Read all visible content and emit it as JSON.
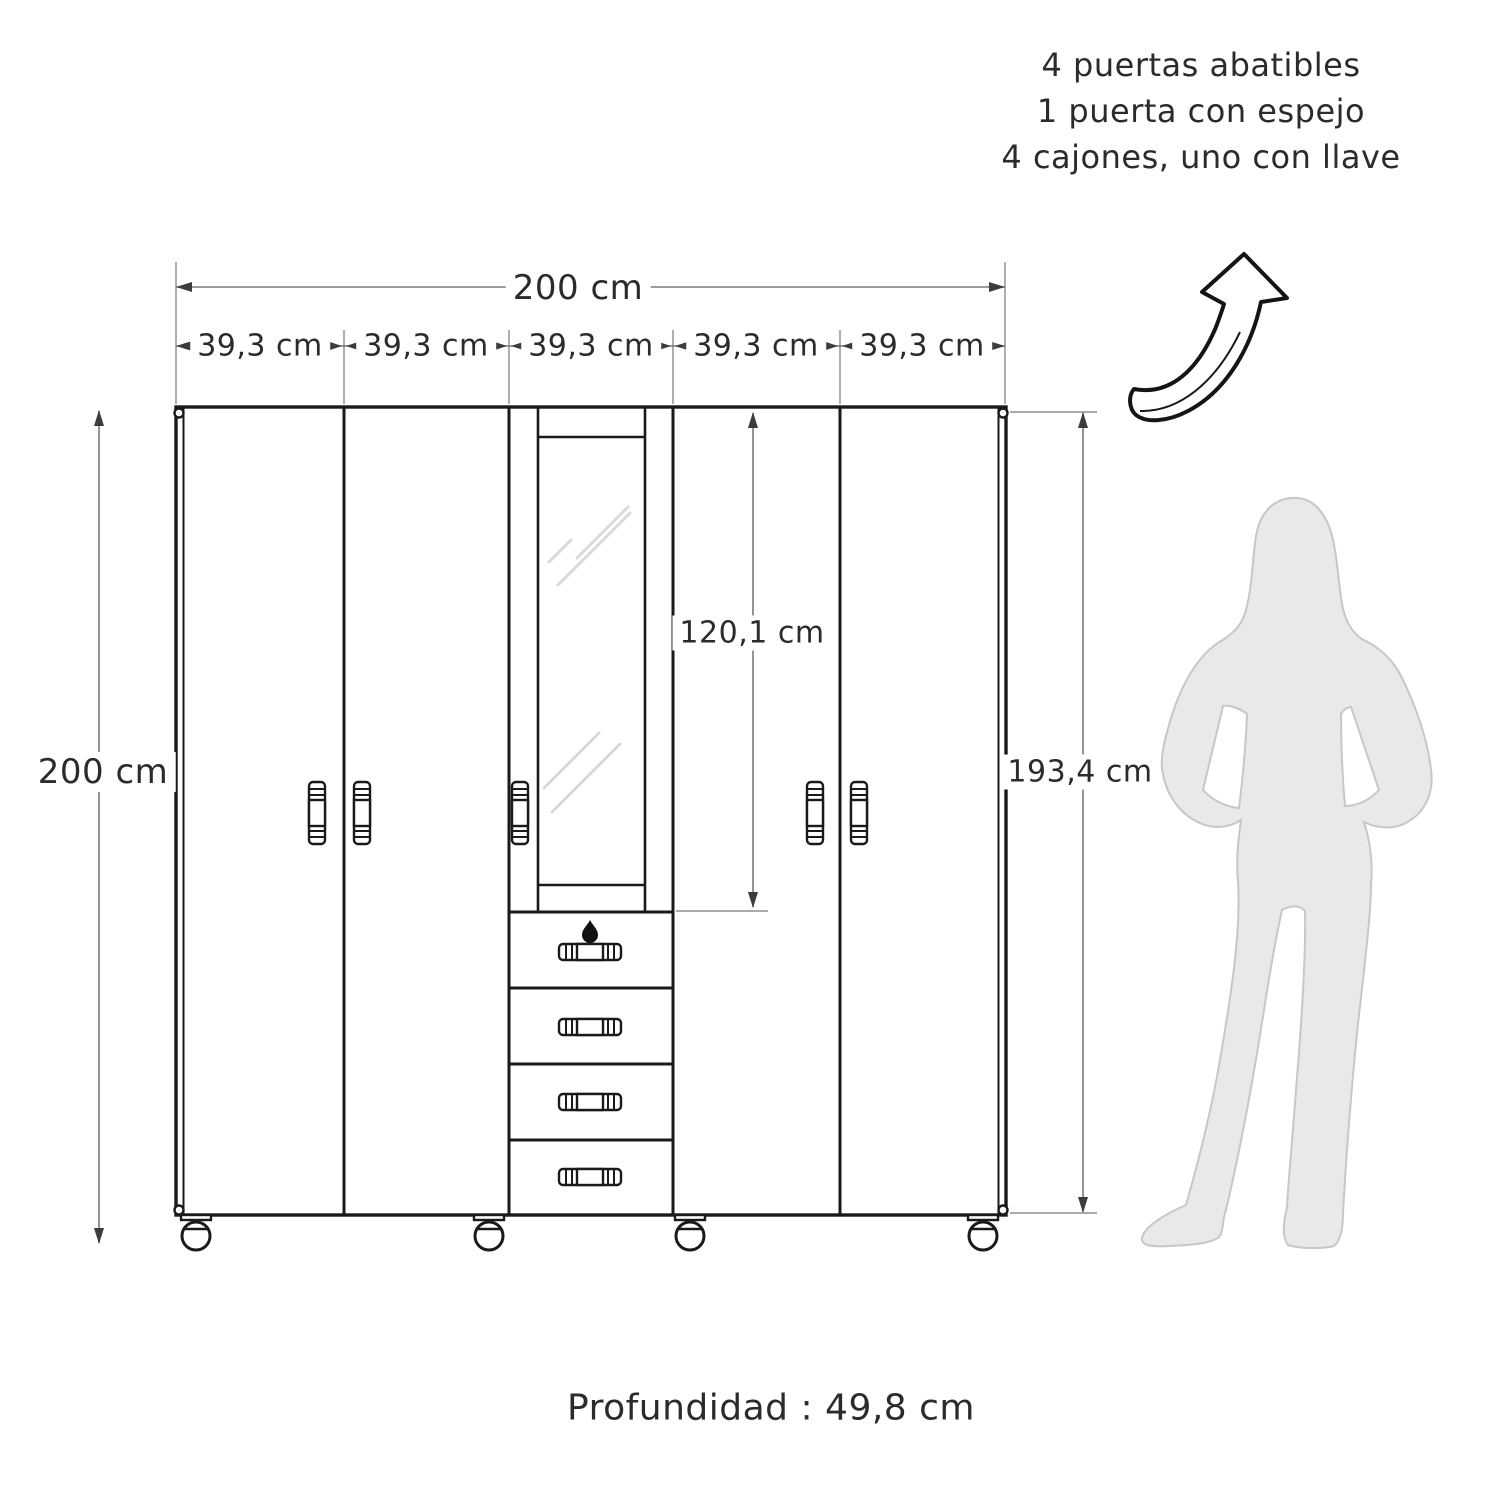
{
  "notes": {
    "lines": [
      "4 puertas abatibles",
      "1 puerta con espejo",
      "4 cajones, uno con llave"
    ]
  },
  "dimensions": {
    "total_width": "200 cm",
    "section_widths": [
      "39,3 cm",
      "39,3 cm",
      "39,3 cm",
      "39,3 cm",
      "39,3 cm"
    ],
    "total_height": "200 cm",
    "body_height": "193,4 cm",
    "mirror_door_height": "120,1 cm",
    "depth_note": "Profundidad : 49,8 cm"
  },
  "icons": {
    "arrow": "curved-up-right-arrow",
    "lock": "drawer-keyhole-dot",
    "person": "woman-silhouette-scale-figure"
  },
  "colors": {
    "outline": "#1a1a1a",
    "dimension_line": "#7a7a7a",
    "text": "#2b2b2b",
    "silhouette_fill": "#e9e9e9",
    "silhouette_outline": "#c7c7c7",
    "mirror_reflection": "#d9d9dd",
    "background": "#ffffff"
  }
}
